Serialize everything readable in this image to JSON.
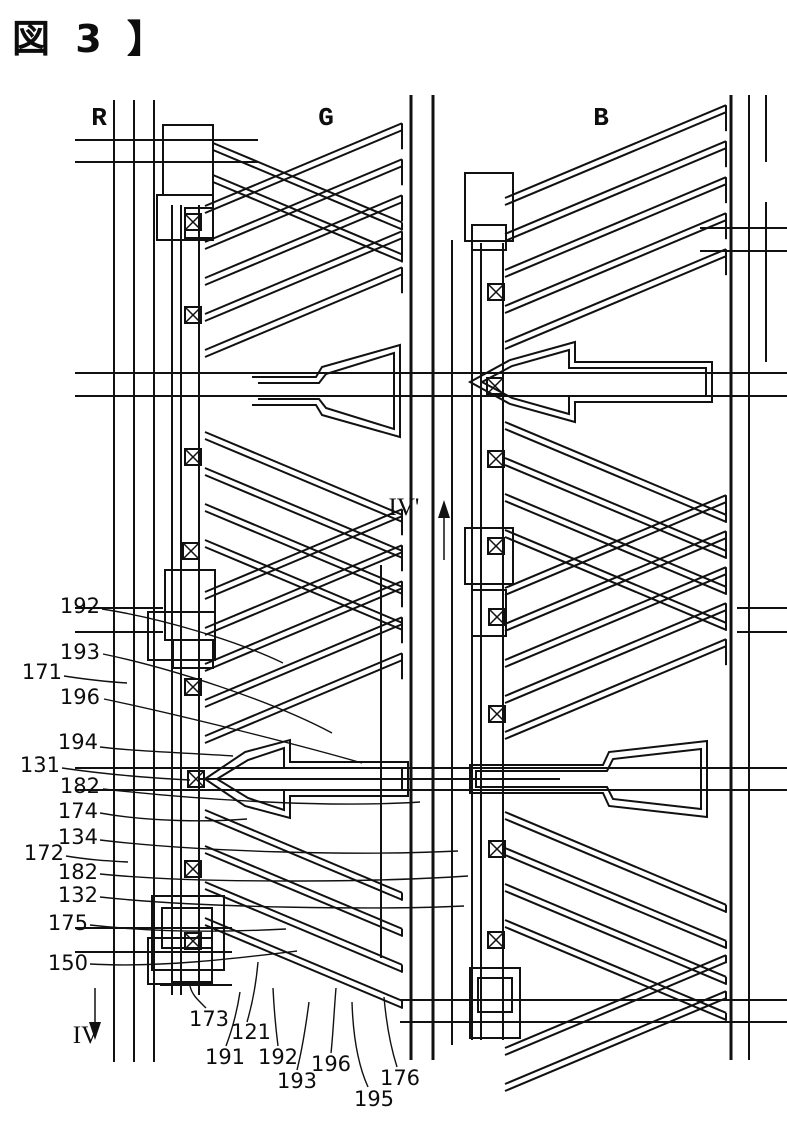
{
  "figure": {
    "title": "図 3 】"
  },
  "column_labels": {
    "r": "R",
    "g": "G",
    "b": "B"
  },
  "section_markers": {
    "top": "IV'",
    "bottom": "IV"
  },
  "left_labels": [
    "192",
    "193",
    "171",
    "196",
    "194",
    "131",
    "182",
    "174",
    "134",
    "172",
    "182",
    "132",
    "175",
    "150"
  ],
  "bottom_labels": [
    "173",
    "121",
    "191",
    "192",
    "193",
    "196",
    "195",
    "176"
  ],
  "icons": {
    "contact_hole": "x-box-contact-icon",
    "section_arrow_up": "arrow-up-icon",
    "section_arrow_down": "arrow-down-icon"
  },
  "colors": {
    "line": "#111111",
    "background": "#ffffff"
  }
}
